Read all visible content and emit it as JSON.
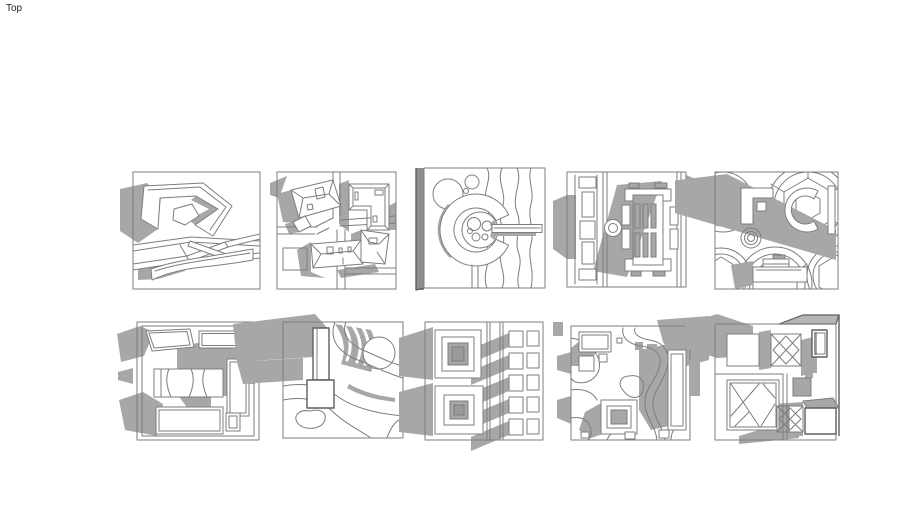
{
  "viewport": {
    "view_label": "Top",
    "background_color": "#ffffff"
  },
  "palette": {
    "line_color": "#7d7d7d",
    "profile_line_color": "#5e5e5e",
    "shadow_color": "#a7a7a7",
    "side_face_color": "#8f8f8f"
  },
  "tiles": [
    {
      "id": "tile-1",
      "name": "angular-hook-terrace-plan"
    },
    {
      "id": "tile-2",
      "name": "hip-roof-houses-plan"
    },
    {
      "id": "tile-3",
      "name": "circular-ring-contour-plan"
    },
    {
      "id": "tile-4",
      "name": "symmetric-formal-building-plan"
    },
    {
      "id": "tile-5",
      "name": "geodesic-domes-plan"
    },
    {
      "id": "tile-6",
      "name": "rectangular-courtyards-plan"
    },
    {
      "id": "tile-7",
      "name": "tower-and-contours-plan"
    },
    {
      "id": "tile-8",
      "name": "nested-squares-and-grid-plan"
    },
    {
      "id": "tile-9",
      "name": "river-contours-blocks-plan"
    },
    {
      "id": "tile-10",
      "name": "braced-frames-courtyard-plan"
    }
  ]
}
